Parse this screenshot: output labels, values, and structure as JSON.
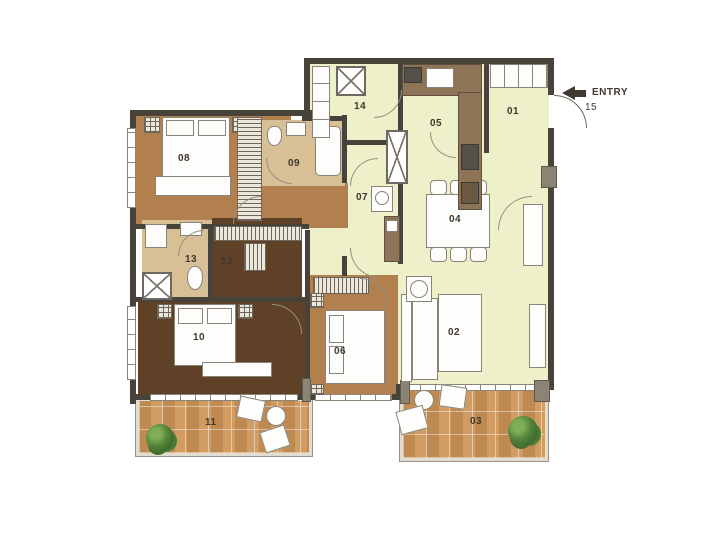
{
  "entry": {
    "label": "ENTRY",
    "number": "15"
  },
  "rooms": {
    "r01": {
      "label": "01"
    },
    "r02": {
      "label": "02"
    },
    "r03": {
      "label": "03"
    },
    "r04": {
      "label": "04"
    },
    "r05": {
      "label": "05"
    },
    "r06": {
      "label": "06"
    },
    "r07": {
      "label": "07"
    },
    "r08": {
      "label": "08"
    },
    "r09": {
      "label": "09"
    },
    "r10": {
      "label": "10"
    },
    "r11": {
      "label": "11"
    },
    "r12": {
      "label": "12"
    },
    "r13": {
      "label": "13"
    },
    "r14": {
      "label": "14"
    }
  },
  "colors": {
    "living_floor": "#eef0c9",
    "bedroom_floor": "#b2804f",
    "master_floor": "#5e4126",
    "bath_floor": "#d8c096",
    "terrace_tile": "#cf9a60",
    "wall": "#47433a",
    "counter": "#8d7456"
  }
}
